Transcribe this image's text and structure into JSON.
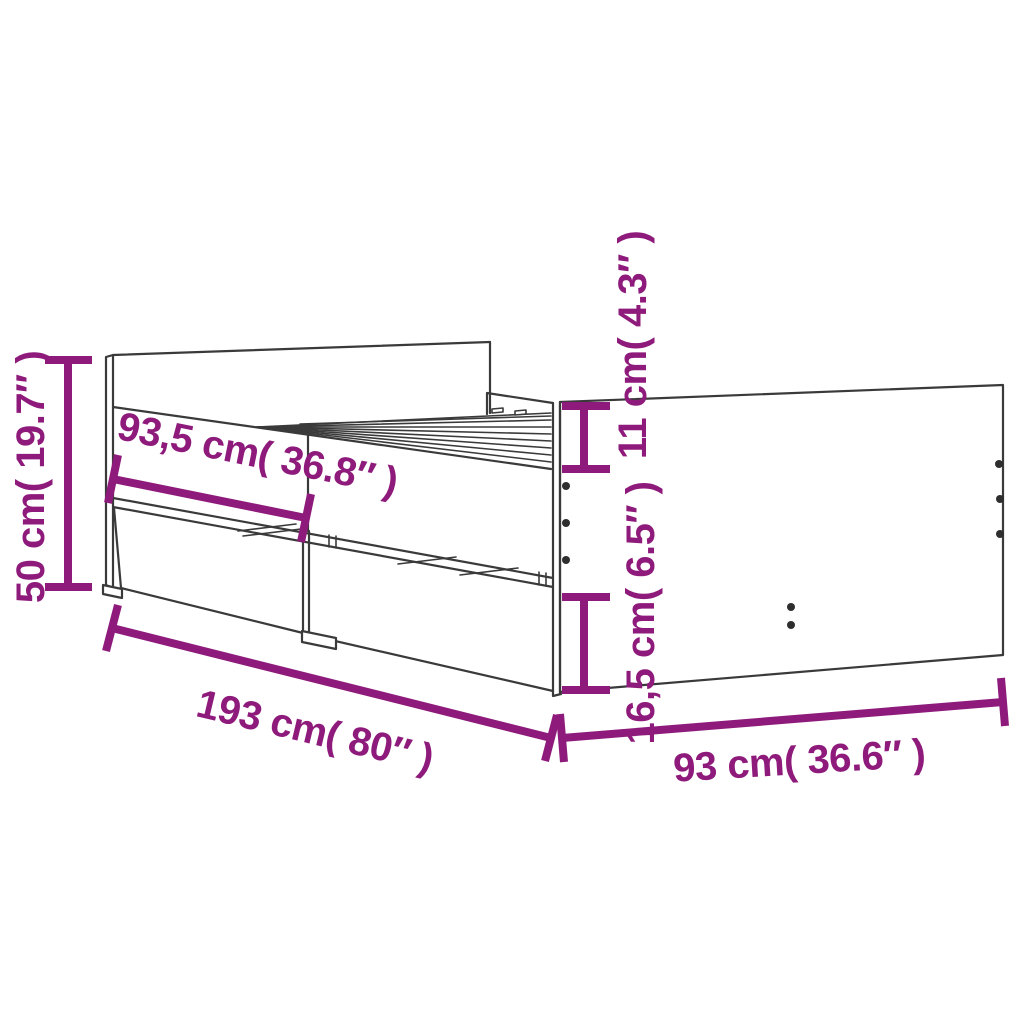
{
  "diagram": {
    "type": "product-dimension-diagram",
    "subject": "bed frame with drawers",
    "background_color": "#ffffff",
    "line_color": "#3a3a3a",
    "hole_color": "#2e2e2e",
    "accent_color": "#8e1b7b",
    "dimensions": {
      "overall_height": {
        "label": "50 cm( 19.7″ )"
      },
      "drawer_span": {
        "label": "93,5 cm( 36.8″ )"
      },
      "top_rail_height": {
        "label": "11 cm( 4.3″ )"
      },
      "drawer_front_height": {
        "label": "16,5 cm( 6.5″ )"
      },
      "overall_length": {
        "label": "193 cm( 80″ )"
      },
      "overall_width": {
        "label": "93 cm( 36.6″ )"
      }
    }
  }
}
